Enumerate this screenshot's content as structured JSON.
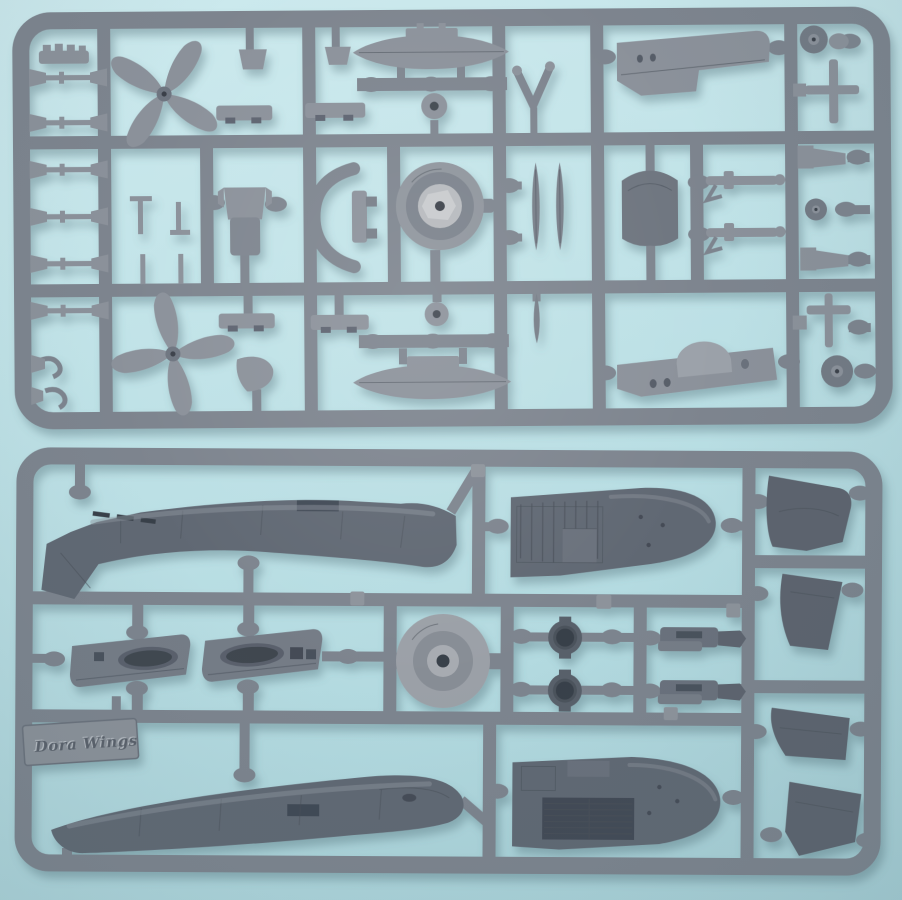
{
  "scene": {
    "type": "photograph",
    "subject": "Two grey injection-moulded polystyrene sprues (parts frames) of a scale aircraft model kit, photographed on a pale blue surface",
    "colors": {
      "background_top": "#cdeaee",
      "background_mid": "#bfe2e7",
      "background_bottom": "#a9d2d9",
      "runner_grey": "#7d848e",
      "part_grey_light": "#8b919a",
      "part_grey_mid": "#767d87",
      "part_grey_dark": "#616873",
      "recess_dark": "#3f4650",
      "silver_sheen": "#b6b9bd",
      "shadow": "#4e6e78"
    }
  },
  "branding": {
    "embossed_logo_text": "Dora Wings",
    "logo_treatment": "raised italic script on a rectangular tab moulded into the lower sprue"
  },
  "sprues": [
    {
      "id": "sprue-a",
      "position": "top",
      "parts_visible": [
        "four-blade propeller (x2)",
        "drop tank half (x2)",
        "engine cowling front ring",
        "pilot seat",
        "underwing rack (x4)",
        "main wheel (x2)",
        "tail wheel",
        "landing gear leg (x2)",
        "gear door blade (x3)",
        "cowl side panel (x2)",
        "chin radiator housing",
        "small pin and linkage parts (x6)",
        "exhaust stub strip",
        "antenna mast",
        "cone fairing (x2)"
      ]
    },
    {
      "id": "sprue-b",
      "position": "bottom",
      "parts_visible": [
        "port fuselage half",
        "starboard fuselage half",
        "upper wing half",
        "lower wing half",
        "tail cone / cowl segment (x4)",
        "carburettor intake fairing (x2)",
        "wheel hub disc",
        "cowl ring (x2)",
        "exhaust manifold (x2)",
        "manufacturer logo tab"
      ]
    }
  ]
}
